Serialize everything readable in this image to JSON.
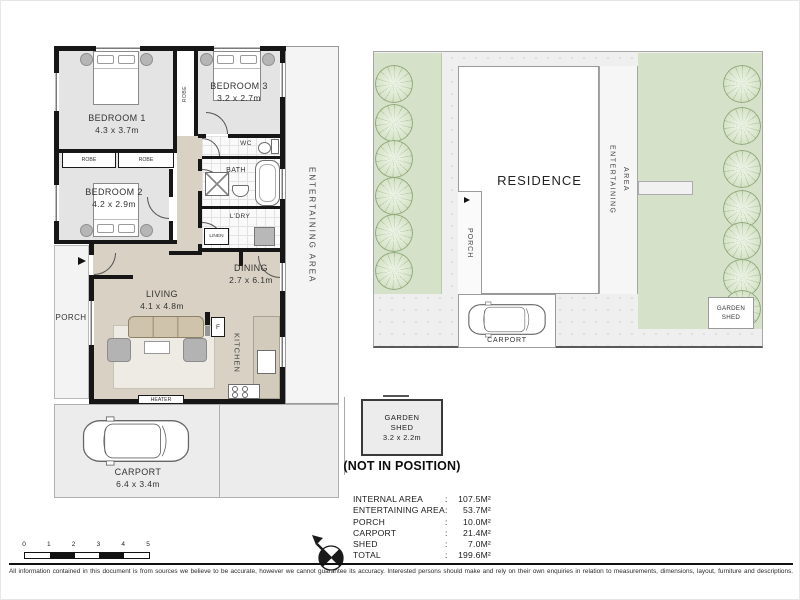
{
  "colors": {
    "wall": "#161616",
    "bedroom_floor": "#e4e4e4",
    "hall_floor": "#d9d2c4",
    "tile_floor": "#fafafa",
    "garden_green": "#d5e1c8",
    "paving_grey": "#efefef",
    "counter_beige": "#d2cbbc"
  },
  "floorplan": {
    "bedroom1_name": "BEDROOM 1",
    "bedroom1_dims": "4.3 x 3.7m",
    "bedroom2_name": "BEDROOM 2",
    "bedroom2_dims": "4.2 x 2.9m",
    "bedroom3_name": "BEDROOM 3",
    "bedroom3_dims": "3.2 x 2.7m",
    "living_name": "LIVING",
    "living_dims": "4.1 x 4.8m",
    "dining_name": "DINING",
    "dining_dims": "2.7 x 6.1m",
    "kitchen": "KITCHEN",
    "fridge": "F",
    "heater": "HEATER",
    "wc": "WC",
    "bath": "BATH",
    "laundry": "L'DRY",
    "linen": "LINEN",
    "robe": "ROBE",
    "porch": "PORCH",
    "entertaining": "ENTERTAINING AREA",
    "carport_name": "CARPORT",
    "carport_dims": "6.4 x 3.4m"
  },
  "siteplan": {
    "residence": "RESIDENCE",
    "porch": "PORCH",
    "entertaining_line1": "ENTERTAINING",
    "entertaining_line2": "AREA",
    "carport": "CARPORT",
    "shed_line1": "GARDEN",
    "shed_line2": "SHED"
  },
  "shed_detail": {
    "line1": "GARDEN",
    "line2": "SHED",
    "dims": "3.2 x 2.2m",
    "note": "(NOT IN POSITION)"
  },
  "areas": {
    "rows": [
      {
        "label": "INTERNAL AREA",
        "sep": ":",
        "value": "107.5M²"
      },
      {
        "label": "ENTERTAINING AREA",
        "sep": ":",
        "value": "53.7M²"
      },
      {
        "label": "PORCH",
        "sep": ":",
        "value": "10.0M²"
      },
      {
        "label": "CARPORT",
        "sep": ":",
        "value": "21.4M²"
      },
      {
        "label": "SHED",
        "sep": ":",
        "value": "7.0M²"
      },
      {
        "label": "TOTAL",
        "sep": ":",
        "value": "199.6M²"
      }
    ]
  },
  "scalebar": {
    "ticks": [
      "0",
      "1",
      "2",
      "3",
      "4",
      "5"
    ]
  },
  "disclaimer": "All information contained in this document is from sources we believe to be accurate, however we cannot guarantee its accuracy.  Interested persons should make and rely on their own enquiries in relation to measurements, dimensions, layout, furniture and descriptions."
}
